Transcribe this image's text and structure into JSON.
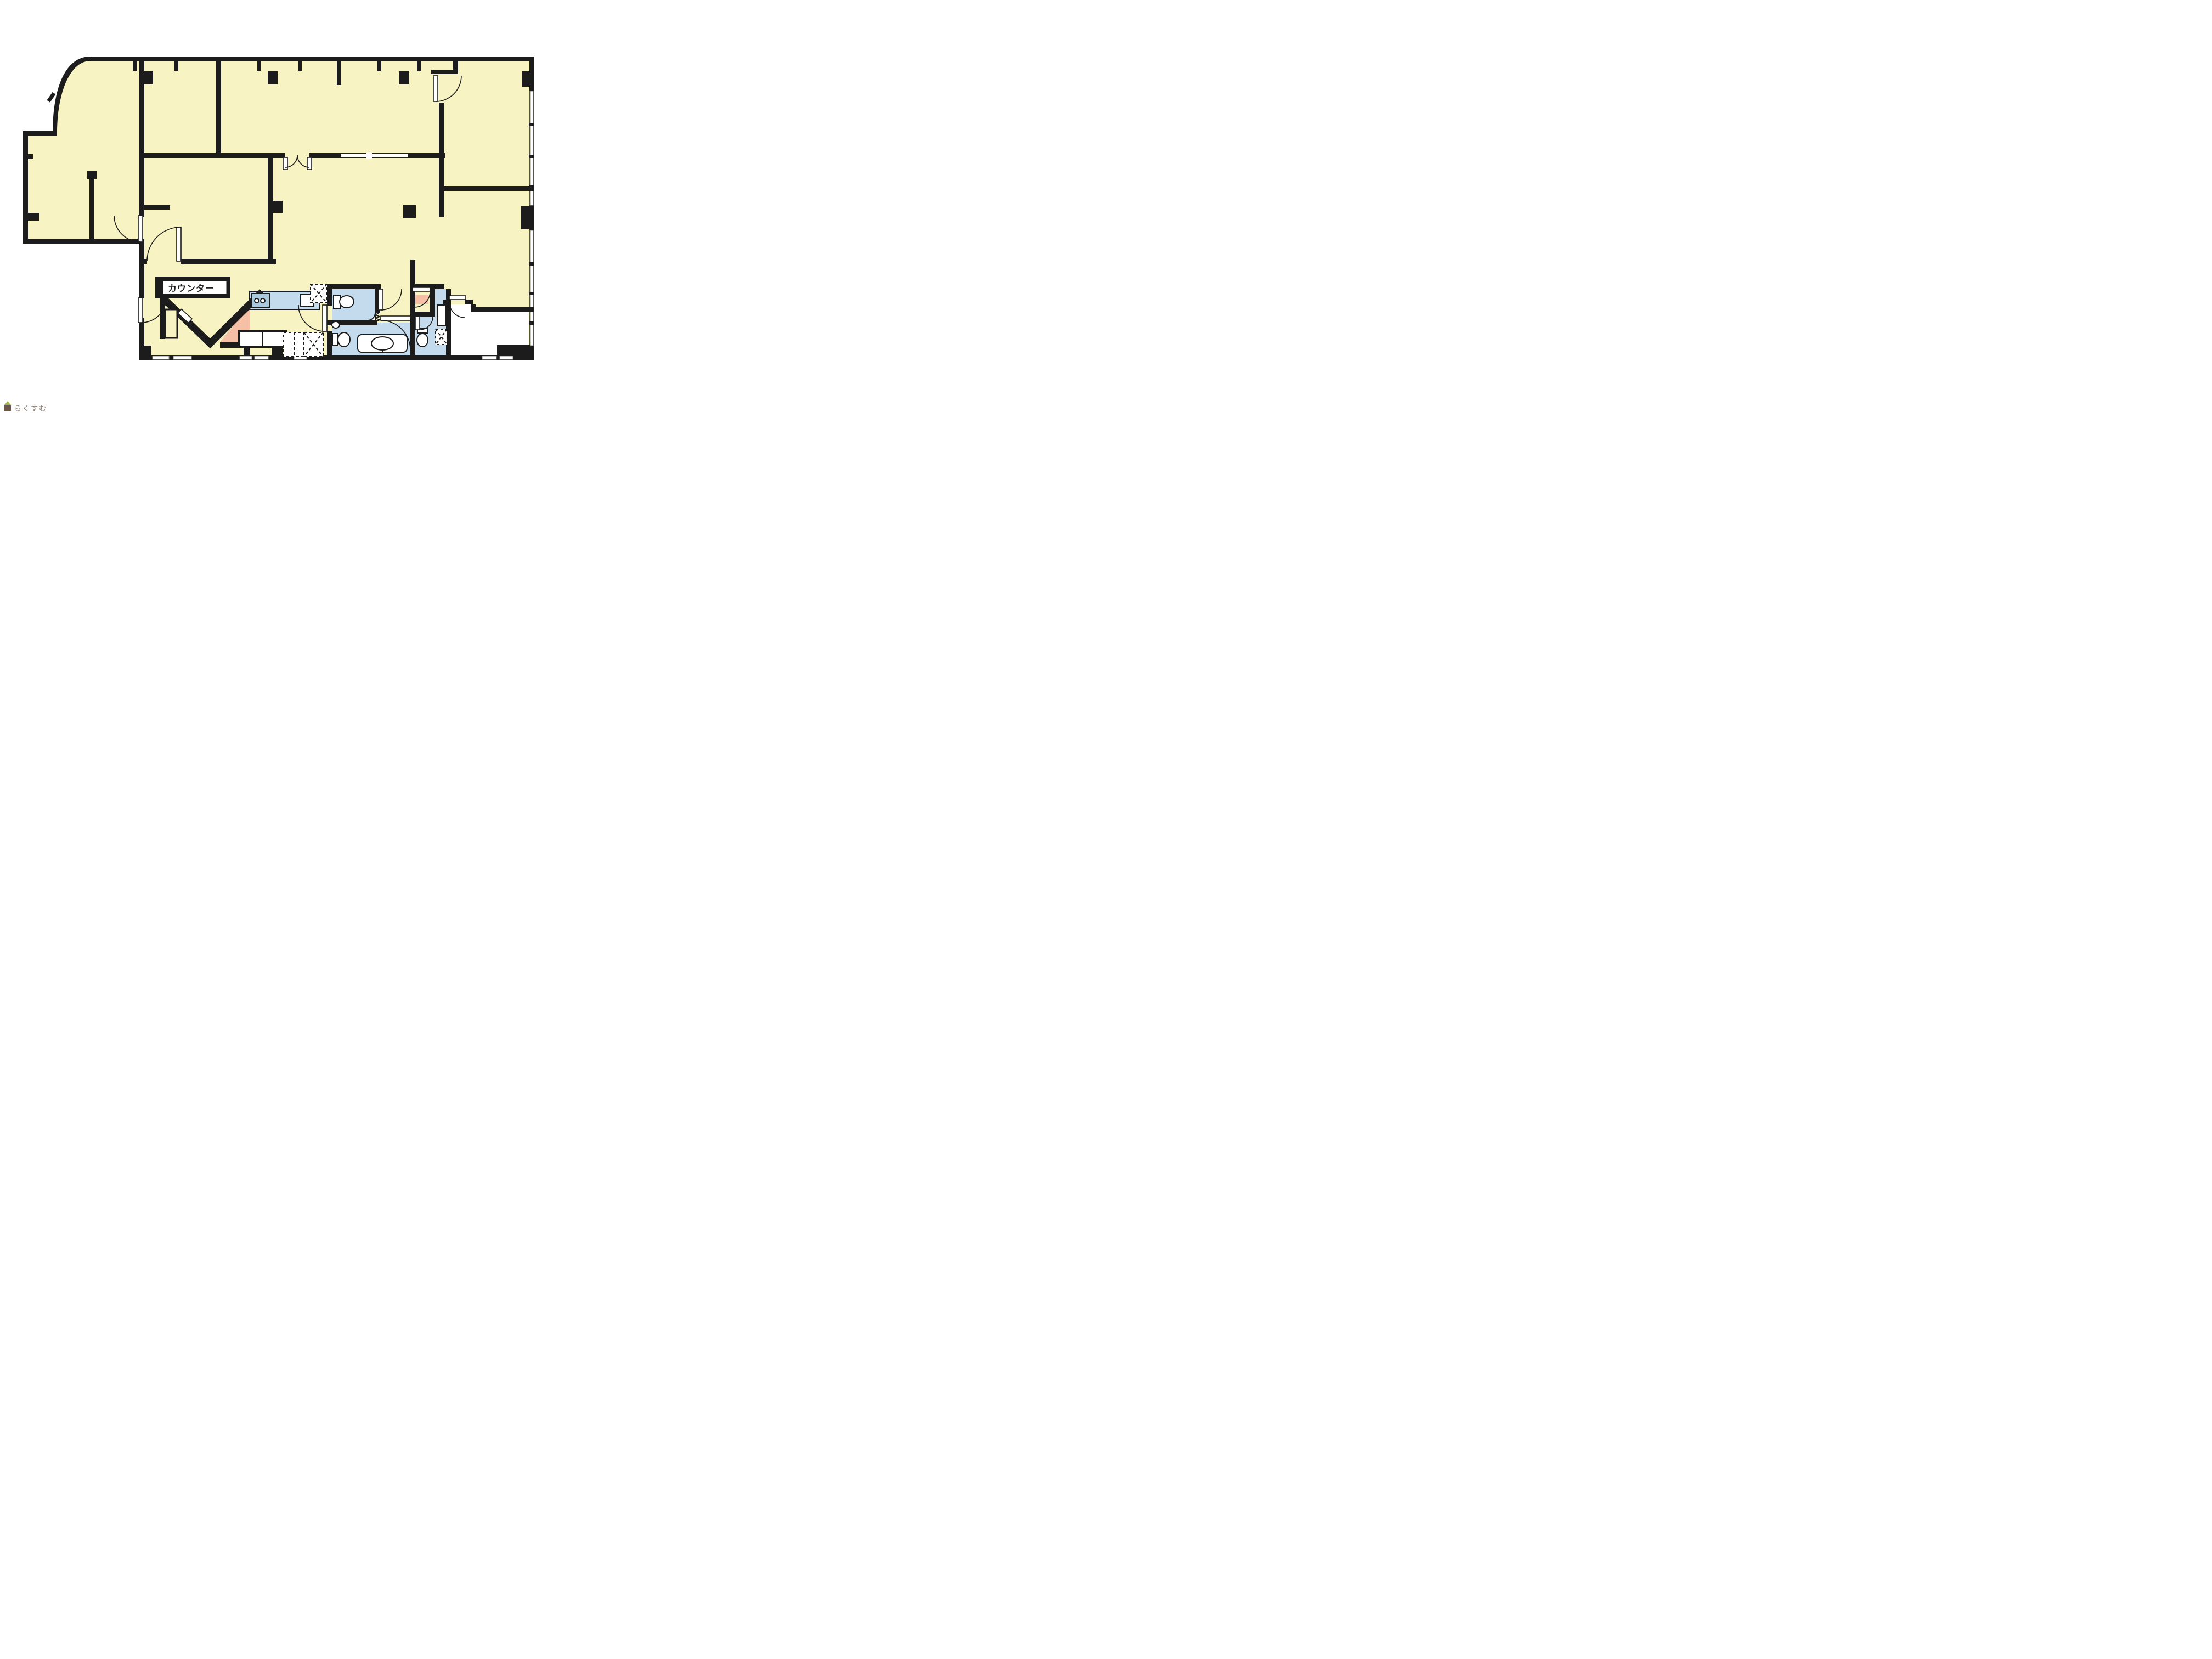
{
  "page": {
    "kind": "real-estate floor plan screenshot",
    "orientation": "landscape"
  },
  "labels": {
    "counter": "カウンター"
  },
  "watermark": {
    "site_name": "らくすむ"
  },
  "colors": {
    "background": "#ffffff",
    "floor": "#f8f3c2",
    "wet_area": "#c3dbed",
    "accent_pink": "#f6c0a6",
    "wall": "#1c1c1c",
    "kitchen_panel": "#aac8de",
    "watermark_roof": "#a9b53d",
    "watermark_body": "#6b5648",
    "watermark_text": "#8a7a6e"
  },
  "rooms": [
    {
      "name": "curved-corner-office"
    },
    {
      "name": "west-office"
    },
    {
      "name": "middle-west-room"
    },
    {
      "name": "top-middle-room"
    },
    {
      "name": "top-wide-room"
    },
    {
      "name": "top-right-room"
    },
    {
      "name": "east-large-room"
    },
    {
      "name": "central-hall"
    },
    {
      "name": "dining-counter-area"
    },
    {
      "name": "kitchenette"
    },
    {
      "name": "wc-block-center"
    },
    {
      "name": "wc-block-east"
    },
    {
      "name": "white-room-southeast"
    }
  ],
  "fixtures": [
    {
      "name": "counter",
      "label_ref": "labels.counter"
    },
    {
      "name": "double-swing-door"
    },
    {
      "name": "toilets",
      "count": 3
    },
    {
      "name": "vanity-sink"
    },
    {
      "name": "corner-hand-sink"
    },
    {
      "name": "pipe-space-boxes",
      "count": 3
    },
    {
      "name": "service-table"
    },
    {
      "name": "kitchen-burners"
    },
    {
      "name": "kitchen-sink"
    }
  ]
}
